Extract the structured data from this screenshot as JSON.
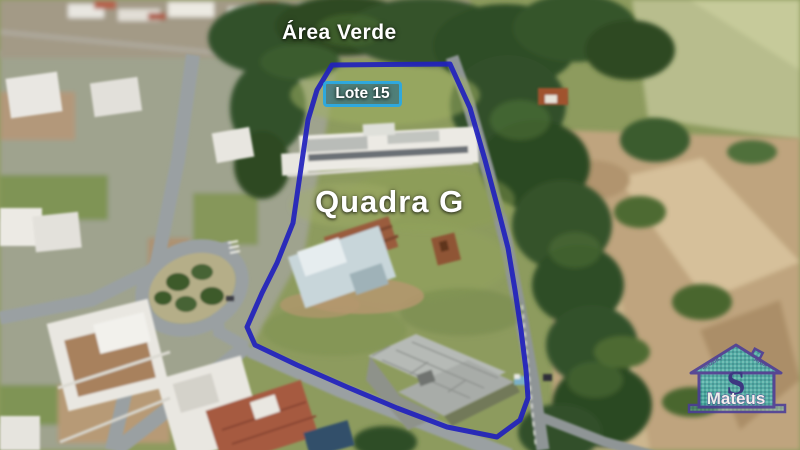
{
  "annotations": {
    "area_label": "Área Verde",
    "lot_label": "Lote 15",
    "block_label": "Quadra G"
  },
  "logo": {
    "initial": "S",
    "name": "Mateus",
    "roof_text_left": "IMOBILI",
    "roof_text_right": "ÁRIA"
  },
  "colors": {
    "boundary": "#2121bd",
    "lot_box_border": "#2fa8dc",
    "lot_box_fill": "rgba(22,95,140,0.55)",
    "label_text": "#ffffff",
    "logo_outline": "#4b3d99",
    "logo_fill": "#45aaa8",
    "logo_initial": "#2e2c85"
  }
}
